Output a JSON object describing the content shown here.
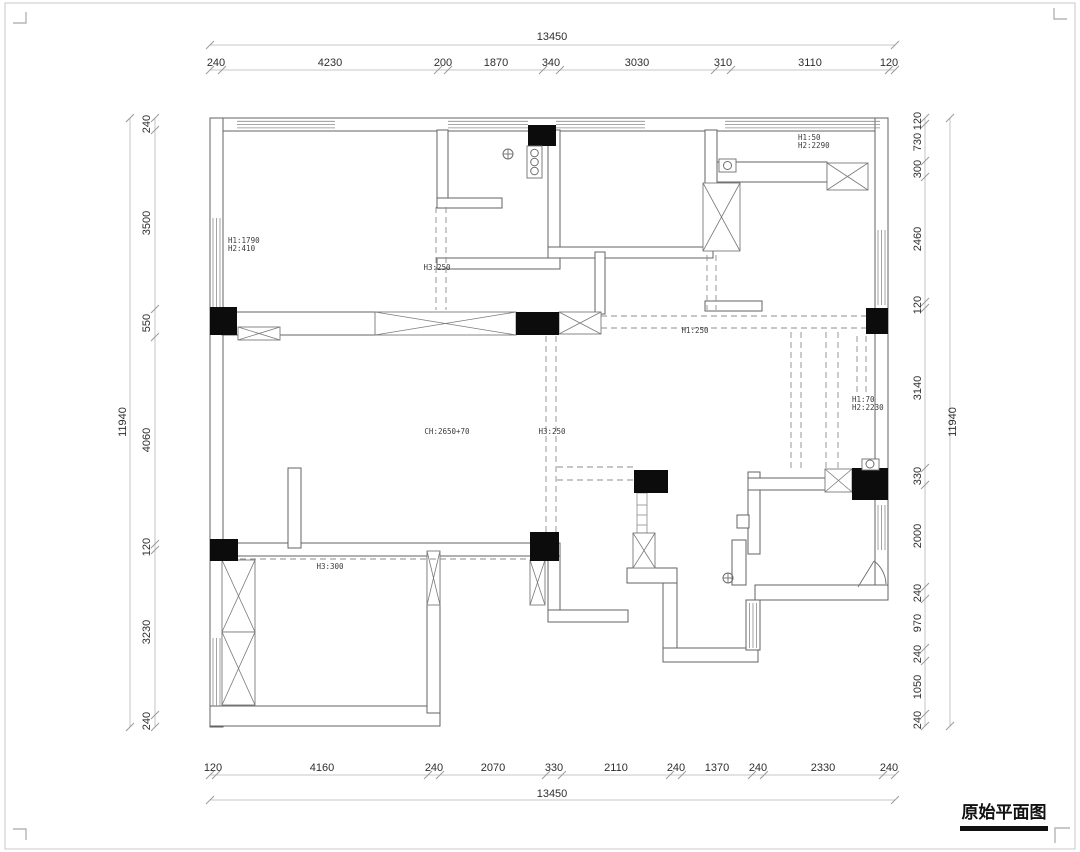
{
  "page": {
    "title_block": "原始平面图"
  },
  "dimensions": {
    "top": {
      "total": "13450",
      "segments": [
        "240",
        "4230",
        "200",
        "1870",
        "340",
        "3030",
        "310",
        "3110",
        "120"
      ]
    },
    "bottom": {
      "total": "13450",
      "segments": [
        "120",
        "4160",
        "240",
        "2070",
        "330",
        "2110",
        "240",
        "1370",
        "240",
        "2330",
        "240"
      ]
    },
    "left": {
      "total": "11940",
      "segments": [
        "240",
        "3500",
        "550",
        "4060",
        "120",
        "3230",
        "240"
      ]
    },
    "right": {
      "total": "11940",
      "segments": [
        "120",
        "730",
        "300",
        "2460",
        "120",
        "3140",
        "330",
        "2000",
        "240",
        "970",
        "240",
        "1050",
        "240"
      ]
    }
  },
  "annotations": {
    "beam_living": {
      "line1": "H1:1790",
      "line2": "H2:410"
    },
    "beam_kitchen": "H3:250",
    "beam_top_right": {
      "line1": "H1:50",
      "line2": "H2:2290"
    },
    "beam_mid": "H1:250",
    "beam_right": {
      "line1": "H1:70",
      "line2": "H2:2230"
    },
    "ceiling_height": "CH:2650+70",
    "beam_center": "H3:250",
    "beam_lower": "H3:300"
  },
  "symbols": {
    "floor_drain": "⊕",
    "stove_burners": "three-circles",
    "door_swing": "quarter-arc"
  },
  "colors": {
    "wall_line": "#636363",
    "column_fill": "#0c0c0c",
    "dim_line": "#b5b5b5",
    "dashed_line": "#8d8d8d",
    "text": "#2e2e2e",
    "background": "#ffffff"
  }
}
